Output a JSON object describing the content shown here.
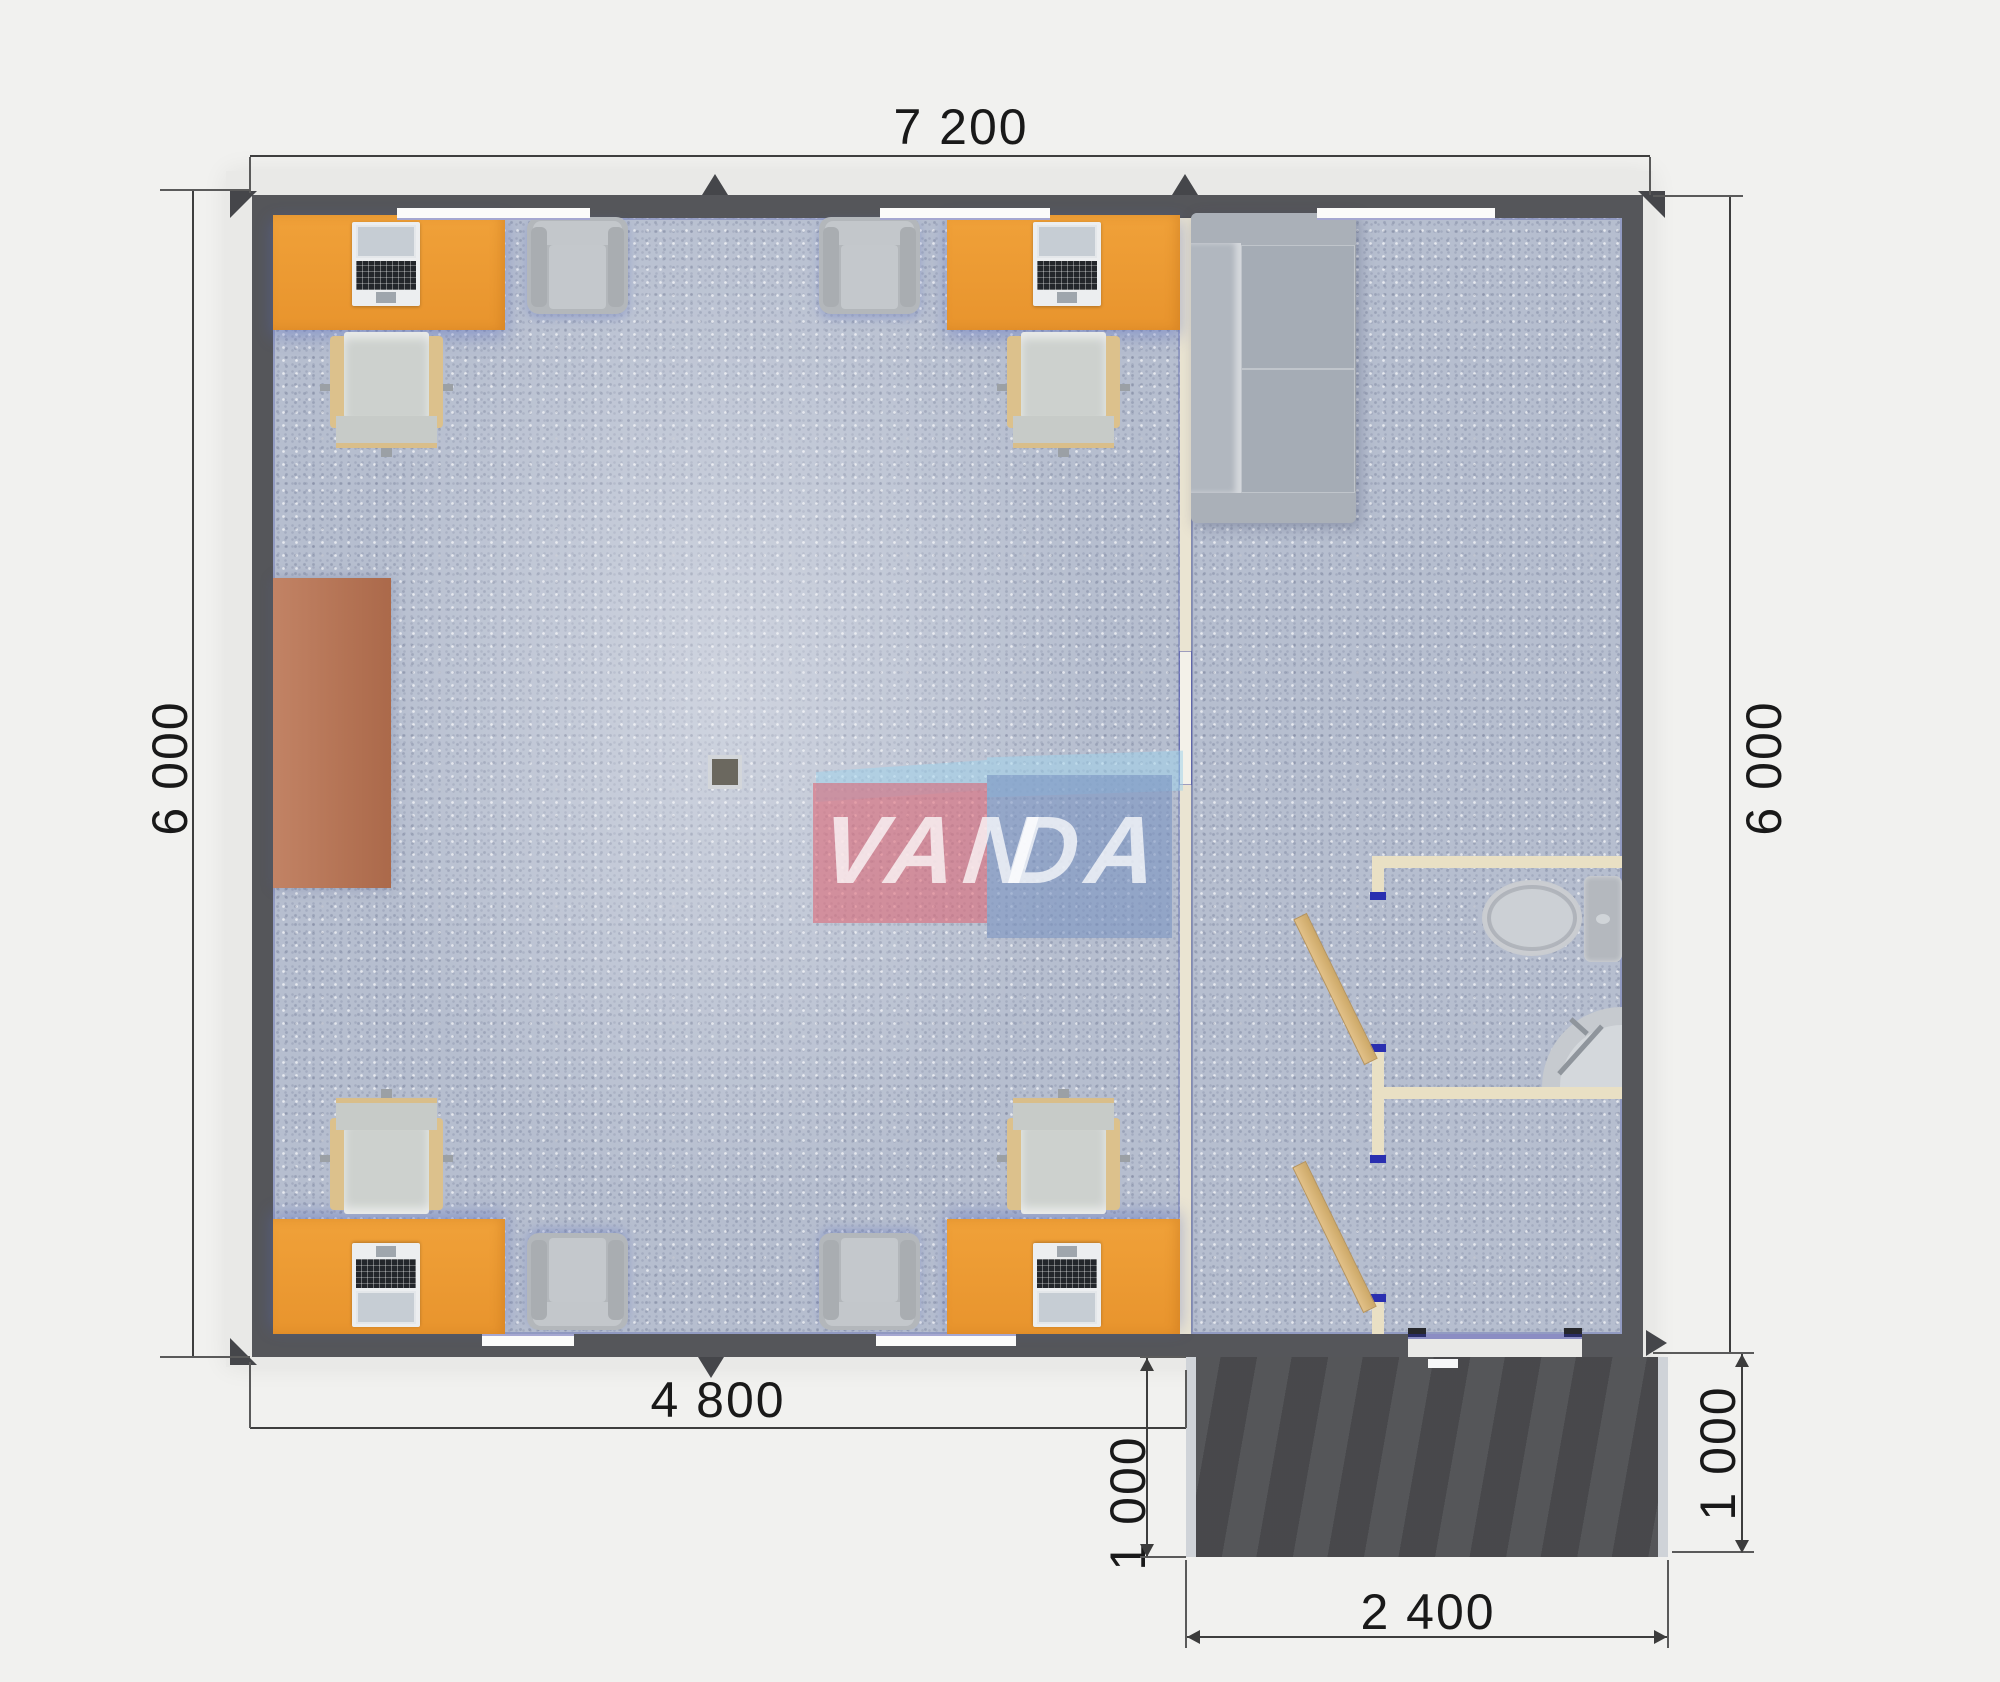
{
  "plan": {
    "title": "modular office floor plan render",
    "watermark": {
      "left_text": "VAN",
      "right_text": "DA"
    },
    "dimensions": {
      "top_width": "7 200",
      "left_height": "6 000",
      "right_height": "6 000",
      "bottom_inner_width": "4 800",
      "porch_depth_left": "1 000",
      "porch_depth_right": "1 000",
      "porch_width": "2 400"
    },
    "colors": {
      "desk": "#e8942d",
      "wall": "#55565a",
      "floor": "#b6becf",
      "cabinet": "#b0714f",
      "porch": "#4c4d50",
      "partition": "#eae4d2",
      "watermark_pink": "#df6075",
      "watermark_blue": "#7d93c1",
      "watermark_light": "#a0d2ec"
    }
  }
}
